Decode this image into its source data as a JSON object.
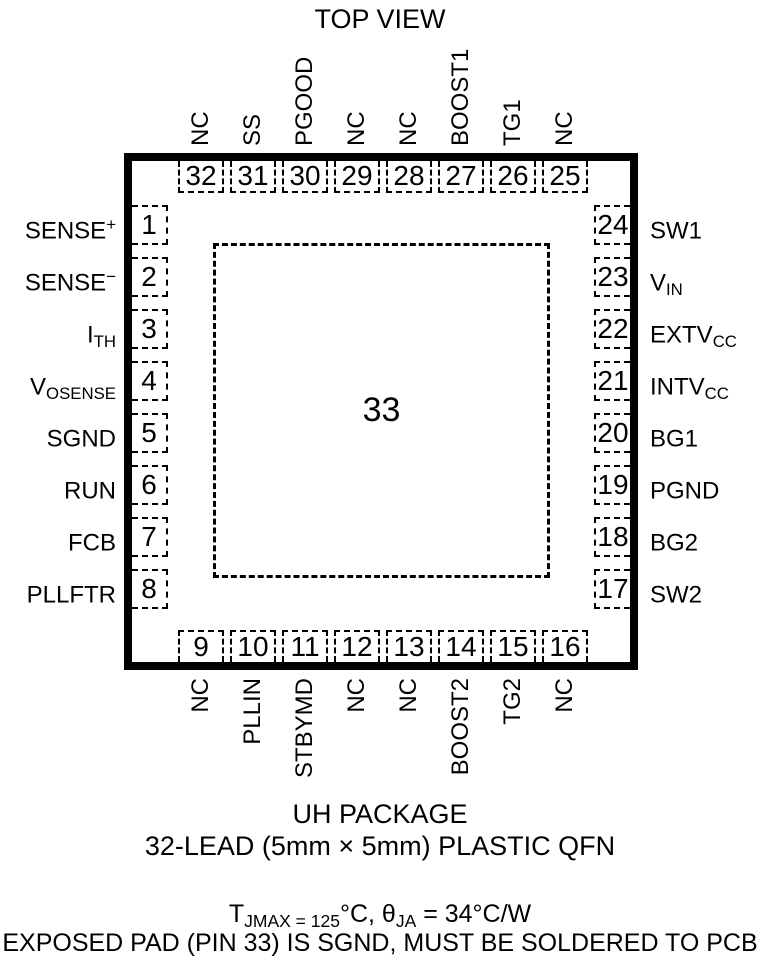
{
  "title": "TOP VIEW",
  "package": {
    "name": "UH PACKAGE",
    "description": "32-LEAD (5mm × 5mm) PLASTIC QFN",
    "center_pad_num": "33"
  },
  "notes": {
    "thermal": {
      "t_base": "T",
      "t_sub": "JMAX = 125",
      "mid": "°C, θ",
      "theta_sub": "JA",
      "tail": " = 34°C/W"
    },
    "exposed_pad": "EXPOSED PAD (PIN 33) IS SGND, MUST BE SOLDERED TO PCB"
  },
  "pins": {
    "top": [
      {
        "num": "32",
        "label": "NC"
      },
      {
        "num": "31",
        "label": "SS"
      },
      {
        "num": "30",
        "label": "PGOOD"
      },
      {
        "num": "29",
        "label": "NC"
      },
      {
        "num": "28",
        "label": "NC"
      },
      {
        "num": "27",
        "label": "BOOST1"
      },
      {
        "num": "26",
        "label": "TG1"
      },
      {
        "num": "25",
        "label": "NC"
      }
    ],
    "bottom": [
      {
        "num": "9",
        "label": "NC"
      },
      {
        "num": "10",
        "label": "PLLIN"
      },
      {
        "num": "11",
        "label": "STBYMD"
      },
      {
        "num": "12",
        "label": "NC"
      },
      {
        "num": "13",
        "label": "NC"
      },
      {
        "num": "14",
        "label": "BOOST2"
      },
      {
        "num": "15",
        "label": "TG2"
      },
      {
        "num": "16",
        "label": "NC"
      }
    ],
    "left": [
      {
        "num": "1",
        "base": "SENSE",
        "sup": "+",
        "sub": ""
      },
      {
        "num": "2",
        "base": "SENSE",
        "sup": "−",
        "sub": ""
      },
      {
        "num": "3",
        "base": "I",
        "sup": "",
        "sub": "TH"
      },
      {
        "num": "4",
        "base": "V",
        "sup": "",
        "sub": "OSENSE"
      },
      {
        "num": "5",
        "base": "SGND",
        "sup": "",
        "sub": ""
      },
      {
        "num": "6",
        "base": "RUN",
        "sup": "",
        "sub": ""
      },
      {
        "num": "7",
        "base": "FCB",
        "sup": "",
        "sub": ""
      },
      {
        "num": "8",
        "base": "PLLFTR",
        "sup": "",
        "sub": ""
      }
    ],
    "right": [
      {
        "num": "24",
        "base": "SW1",
        "sup": "",
        "sub": ""
      },
      {
        "num": "23",
        "base": "V",
        "sup": "",
        "sub": "IN"
      },
      {
        "num": "22",
        "base": "EXTV",
        "sup": "",
        "sub": "CC"
      },
      {
        "num": "21",
        "base": "INTV",
        "sup": "",
        "sub": "CC"
      },
      {
        "num": "20",
        "base": "BG1",
        "sup": "",
        "sub": ""
      },
      {
        "num": "19",
        "base": "PGND",
        "sup": "",
        "sub": ""
      },
      {
        "num": "18",
        "base": "BG2",
        "sup": "",
        "sub": ""
      },
      {
        "num": "17",
        "base": "SW2",
        "sup": "",
        "sub": ""
      }
    ]
  }
}
